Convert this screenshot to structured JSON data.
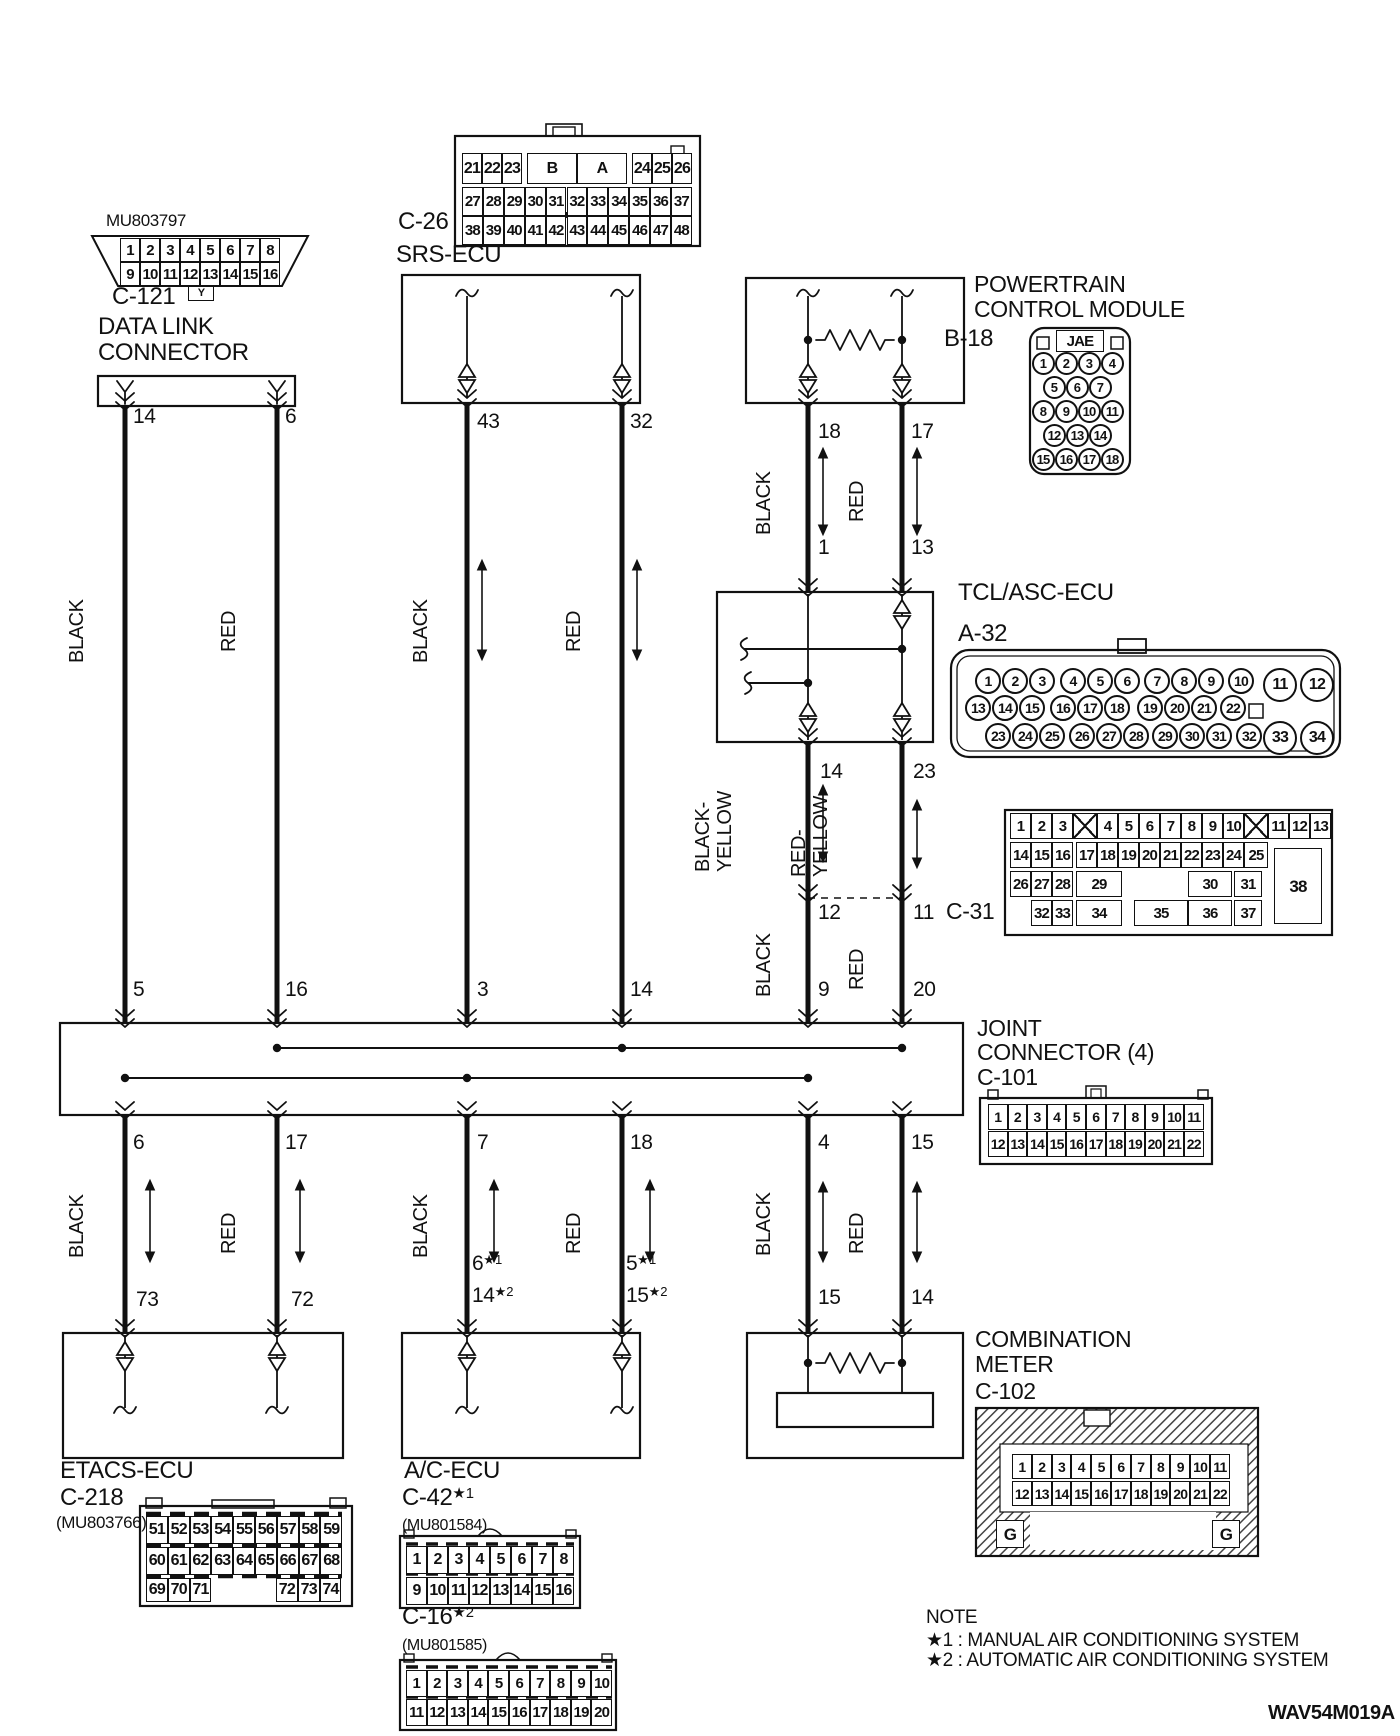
{
  "drawing_code": "WAV54M019A",
  "note": {
    "heading": "NOTE",
    "line1": "★1 : MANUAL AIR CONDITIONING SYSTEM",
    "line2": "★2 : AUTOMATIC AIR CONDITIONING SYSTEM"
  },
  "components": {
    "data_link": {
      "part_no": "MU803797",
      "connector_id": "C-121",
      "name_line1": "DATA LINK",
      "name_line2": "CONNECTOR",
      "tab": "Y",
      "pin_rows": [
        [
          "1",
          "2",
          "3",
          "4",
          "5",
          "6",
          "7",
          "8"
        ],
        [
          "9",
          "10",
          "11",
          "12",
          "13",
          "14",
          "15",
          "16"
        ]
      ]
    },
    "srs_ecu": {
      "connector_id": "C-26",
      "name": "SRS-ECU",
      "row1": [
        "21",
        "22",
        "23",
        "B",
        "A",
        "24",
        "25",
        "26"
      ],
      "row2": [
        "27",
        "28",
        "29",
        "30",
        "31",
        "32",
        "33",
        "34",
        "35",
        "36",
        "37"
      ],
      "row3": [
        "38",
        "39",
        "40",
        "41",
        "42",
        "43",
        "44",
        "45",
        "46",
        "47",
        "48"
      ]
    },
    "pcm": {
      "connector_id": "B-18",
      "name_line1": "POWERTRAIN",
      "name_line2": "CONTROL MODULE",
      "maker": "JAE",
      "pin_rows": [
        [
          "1",
          "2",
          "3",
          "4"
        ],
        [
          "5",
          "6",
          "7"
        ],
        [
          "8",
          "9",
          "10",
          "11"
        ],
        [
          "12",
          "13",
          "14"
        ],
        [
          "15",
          "16",
          "17",
          "18"
        ]
      ]
    },
    "tcl_asc_ecu": {
      "connector_id": "A-32",
      "name": "TCL/ASC-ECU",
      "pin_rows": [
        [
          "1",
          "2",
          "3",
          "4",
          "5",
          "6",
          "7",
          "8",
          "9",
          "10"
        ],
        [
          "13",
          "14",
          "15",
          "16",
          "17",
          "18",
          "19",
          "20",
          "21",
          "22"
        ],
        [
          "23",
          "24",
          "25",
          "26",
          "27",
          "28",
          "29",
          "30",
          "31",
          "32"
        ]
      ],
      "big_pins": [
        "11",
        "12",
        "33",
        "34"
      ]
    },
    "c31": {
      "connector_id": "C-31",
      "row1": [
        "1",
        "2",
        "3",
        "4",
        "5",
        "6",
        "7",
        "8",
        "9",
        "10",
        "11",
        "12",
        "13"
      ],
      "row2": [
        "14",
        "15",
        "16",
        "17",
        "18",
        "19",
        "20",
        "21",
        "22",
        "23",
        "24",
        "25"
      ],
      "row3": [
        "26",
        "27",
        "28",
        "29",
        "30",
        "31"
      ],
      "row4": [
        "32",
        "33",
        "34",
        "35",
        "36",
        "37"
      ],
      "big_pin": "38"
    },
    "joint_connector": {
      "connector_id": "C-101",
      "name_line1": "JOINT",
      "name_line2": "CONNECTOR (4)",
      "pin_rows": [
        [
          "1",
          "2",
          "3",
          "4",
          "5",
          "6",
          "7",
          "8",
          "9",
          "10",
          "11"
        ],
        [
          "12",
          "13",
          "14",
          "15",
          "16",
          "17",
          "18",
          "19",
          "20",
          "21",
          "22"
        ]
      ]
    },
    "combination_meter": {
      "connector_id": "C-102",
      "name_line1": "COMBINATION",
      "name_line2": "METER",
      "ground": "G",
      "pin_rows": [
        [
          "1",
          "2",
          "3",
          "4",
          "5",
          "6",
          "7",
          "8",
          "9",
          "10",
          "11"
        ],
        [
          "12",
          "13",
          "14",
          "15",
          "16",
          "17",
          "18",
          "19",
          "20",
          "21",
          "22"
        ]
      ]
    },
    "etacs_ecu": {
      "connector_id": "C-218",
      "name": "ETACS-ECU",
      "part_no": "(MU803766)",
      "row1": [
        "51",
        "52",
        "53",
        "54",
        "55",
        "56",
        "57",
        "58",
        "59"
      ],
      "row2": [
        "60",
        "61",
        "62",
        "63",
        "64",
        "65",
        "66",
        "67",
        "68"
      ],
      "row3": [
        "69",
        "70",
        "71",
        "72",
        "73",
        "74"
      ]
    },
    "ac_ecu": {
      "name": "A/C-ECU",
      "manual": {
        "connector_id": "C-42",
        "suffix": "★1",
        "part_no": "(MU801584)",
        "pin_rows": [
          [
            "1",
            "2",
            "3",
            "4",
            "5",
            "6",
            "7",
            "8"
          ],
          [
            "9",
            "10",
            "11",
            "12",
            "13",
            "14",
            "15",
            "16"
          ]
        ]
      },
      "auto": {
        "connector_id": "C-16",
        "suffix": "★2",
        "part_no": "(MU801585)",
        "pin_rows": [
          [
            "1",
            "2",
            "3",
            "4",
            "5",
            "6",
            "7",
            "8",
            "9",
            "10"
          ],
          [
            "11",
            "12",
            "13",
            "14",
            "15",
            "16",
            "17",
            "18",
            "19",
            "20"
          ]
        ]
      }
    }
  },
  "wires": {
    "col1": {
      "pins": [
        "14",
        "5",
        "6",
        "73"
      ],
      "color_top": "BLACK",
      "color_bottom": "BLACK"
    },
    "col2": {
      "pins": [
        "6",
        "16",
        "17",
        "72"
      ],
      "color_top": "RED",
      "color_bottom": "RED"
    },
    "col3": {
      "pins": [
        "43",
        "3",
        "7"
      ],
      "pin_manual": {
        "n": "6",
        "sup": "★1"
      },
      "pin_auto": {
        "n": "14",
        "sup": "★2"
      },
      "color_top": "BLACK",
      "color_bottom": "BLACK"
    },
    "col4": {
      "pins": [
        "32",
        "14",
        "18"
      ],
      "pin_manual": {
        "n": "5",
        "sup": "★1"
      },
      "pin_auto": {
        "n": "15",
        "sup": "★2"
      },
      "color_top": "RED",
      "color_bottom": "RED"
    },
    "col5": {
      "pins": [
        "18",
        "1",
        "14",
        "12",
        "9",
        "4",
        "15"
      ],
      "color_top": "BLACK",
      "color_mid_line1": "BLACK-",
      "color_mid_line2": "YELLOW",
      "color_mid2": "BLACK",
      "color_bottom": "BLACK"
    },
    "col6": {
      "pins": [
        "17",
        "13",
        "23",
        "11",
        "20",
        "15",
        "14"
      ],
      "color_top": "RED",
      "color_mid_line1": "RED-",
      "color_mid_line2": "YELLOW",
      "color_mid2": "RED",
      "color_bottom": "RED"
    }
  }
}
